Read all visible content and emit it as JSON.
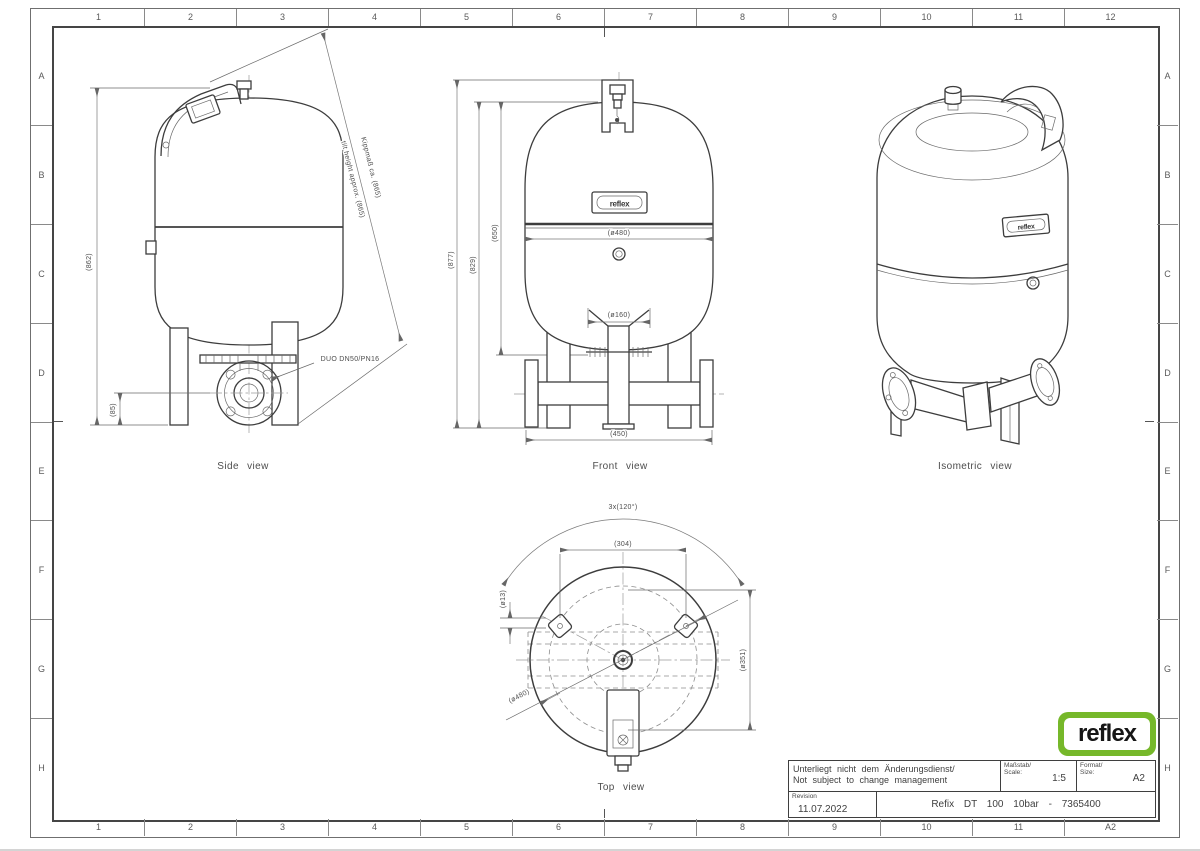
{
  "frame": {
    "columns": [
      "1",
      "2",
      "3",
      "4",
      "5",
      "6",
      "7",
      "8",
      "9",
      "10",
      "11",
      "12"
    ],
    "columns_bottom": [
      "1",
      "2",
      "3",
      "4",
      "5",
      "6",
      "7",
      "8",
      "9",
      "10",
      "11",
      "A2"
    ],
    "rows": [
      "A",
      "B",
      "C",
      "D",
      "E",
      "F",
      "G",
      "H"
    ]
  },
  "logo": {
    "text": "reflex",
    "green": "#76b82a"
  },
  "views": {
    "side": {
      "caption": "Side view",
      "dim_height": "(862)",
      "dim_foot": "(85)",
      "tilt_de": "Kippmaß ca. (865)",
      "tilt_en": "tilt height approx. (865)",
      "connection": "DUO DN50/PN16"
    },
    "front": {
      "caption": "Front view",
      "dim_total": "(877)",
      "dim_vessel": "(829)",
      "dim_seam": "(650)",
      "dim_dia": "(ø480)",
      "dim_dia_small": "(ø160)",
      "dim_feet": "(450)"
    },
    "iso": {
      "caption": "Isometric view"
    },
    "top": {
      "caption": "Top view",
      "dim_angle": "3x(120°)",
      "dim_pads": "(304)",
      "dim_hole": "(ø13)",
      "dim_dia": "(ø480)",
      "dim_circle": "(ø351)"
    }
  },
  "title_block": {
    "note_line1": "Unterliegt nicht dem Änderungsdienst/",
    "note_line2": "Not subject to change management",
    "scale_label_de": "Maßstab/",
    "scale_label_en": "Scale:",
    "scale_value": "1:5",
    "format_label_de": "Format/",
    "format_label_en": "Size:",
    "format_value": "A2",
    "revision_label": "Revision",
    "revision_value": "11.07.2022",
    "title": "Refix DT 100 10bar - 7365400"
  }
}
